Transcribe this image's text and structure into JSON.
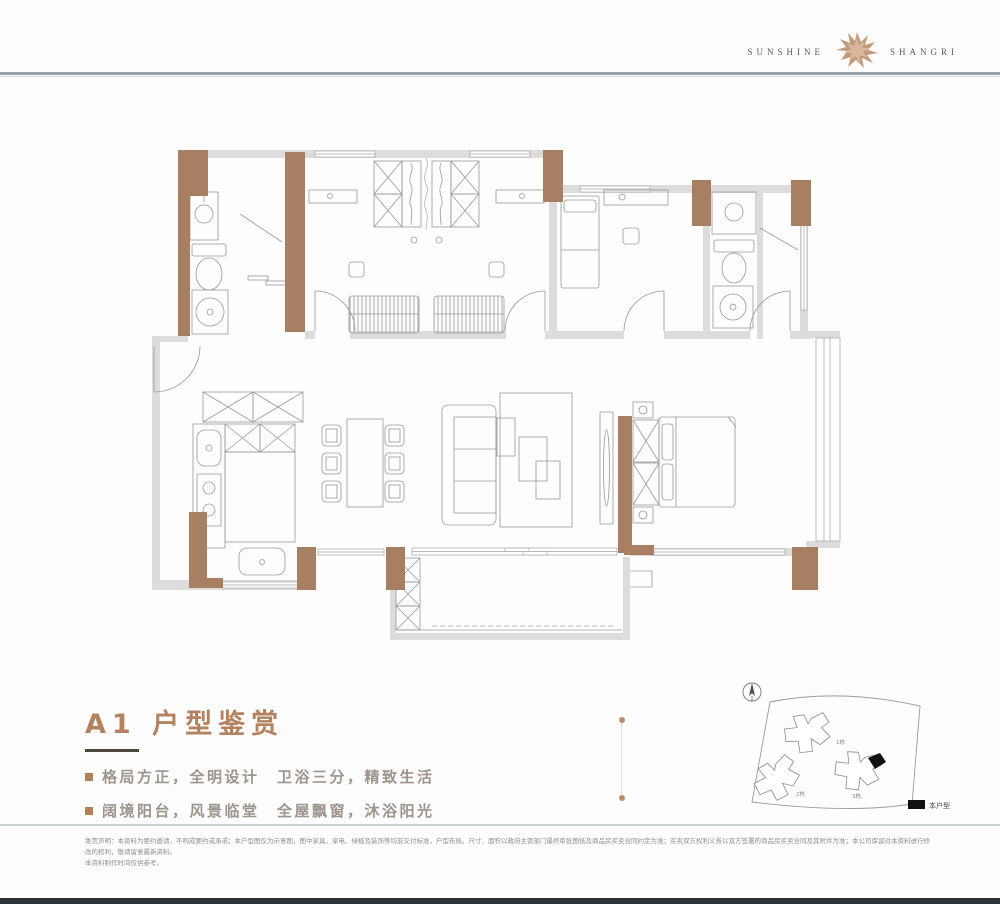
{
  "brand": {
    "name_left": "SUNSHINE",
    "name_right": "SHANGRI"
  },
  "headline": {
    "title": "A1 户型鉴赏",
    "bullets": [
      "格局方正，全明设计　卫浴三分，精致生活",
      "阔境阳台，风景临堂　全屋飘窗，沐浴阳光"
    ]
  },
  "siteplan": {
    "legend": "本户型",
    "buildings": [
      "1栋",
      "2栋",
      "3栋"
    ]
  },
  "disclaimer": {
    "line1": "免责声明：本资料为要约邀请，不构成要约或承诺；本户型图仅为示意图，图中家具、家电、绿植及装饰等均非交付标准，户型布局、尺寸、面积以政府主管部门最终审批图纸及商品房买卖合同约定为准；买卖双方权利义务以双方签署的商品房买卖合同及其附件为准；本公司保留对本资料进行修改的权利，敬请留意最新资料。",
    "line2": "本资料制作时间仅供参考。"
  },
  "colors": {
    "accent": "#b5825f",
    "column": "#a87f63",
    "wall": "#dcdcdc",
    "line": "#9b9b9b",
    "dark_bar": "#2e3237"
  }
}
